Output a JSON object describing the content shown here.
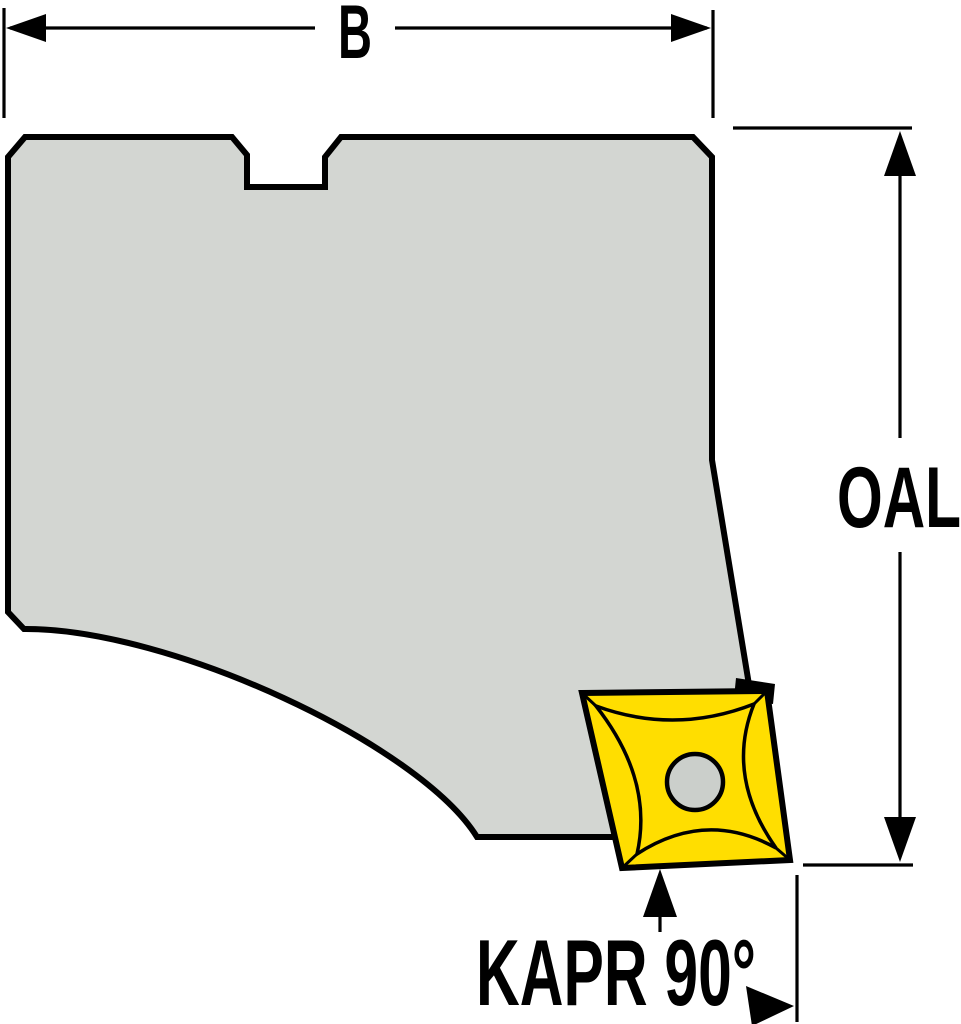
{
  "figure": {
    "type": "technical-drawing",
    "description": "Side view of a milling cartridge / toolholder body with an indexable square insert and dimension callouts",
    "labels": {
      "width": "B",
      "overall_length": "OAL",
      "approach_angle": "KAPR 90°"
    },
    "colors": {
      "background": "#ffffff",
      "body_fill": "#d3d6d2",
      "insert_fill": "#ffde00",
      "hole_fill": "#cbcfcb",
      "line": "#000000"
    }
  }
}
